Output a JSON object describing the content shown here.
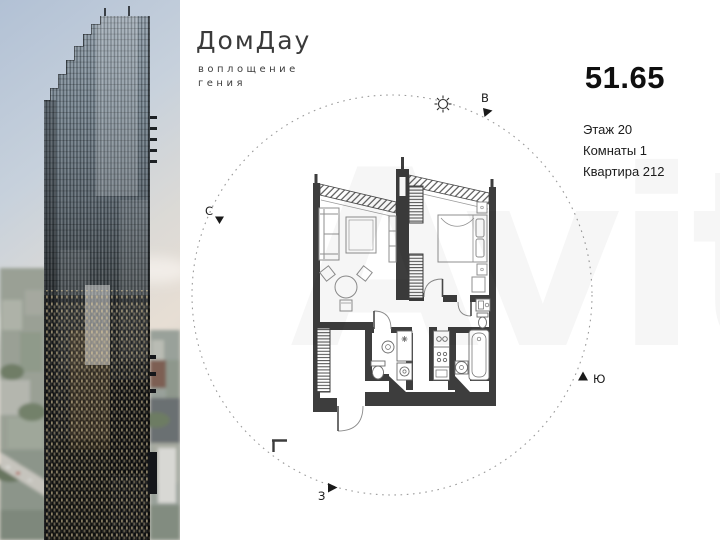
{
  "logo": {
    "title": "ДомДау",
    "tagline_line1": "воплощение",
    "tagline_line2": "гения"
  },
  "listing": {
    "area": "51.65",
    "floor": "Этаж 20",
    "rooms": "Комнаты 1",
    "apartment": "Квартира 212"
  },
  "compass": {
    "north": "С",
    "east": "В",
    "south": "Ю",
    "west": "З"
  },
  "watermark": {
    "text": "Avito"
  },
  "colors": {
    "wall": "#3d3d3d",
    "background": "#ffffff",
    "compass_circle": "#9a9a9a",
    "text_primary": "#111111"
  }
}
